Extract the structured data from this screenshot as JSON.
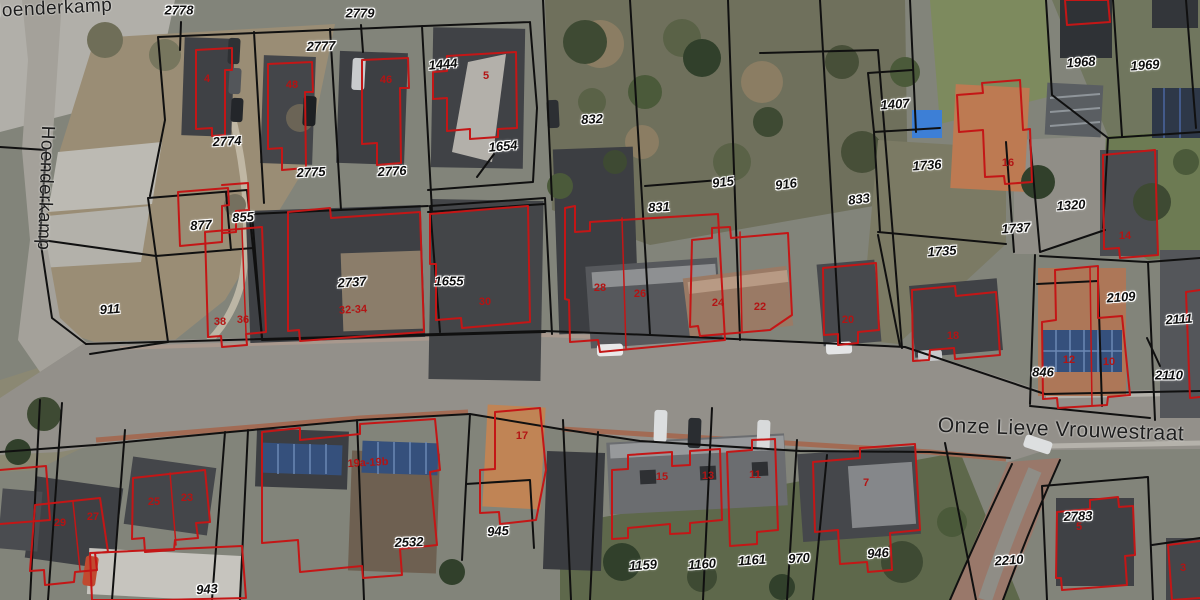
{
  "colors": {
    "parcel_line_color": "#101010",
    "building_outline_color": "#c41616",
    "house_number_color": "#b31414",
    "parcel_label_color": "#0d0d0d",
    "street_label_color": "#1d1d1d",
    "label_halo_color": "#ffffff"
  },
  "map": {
    "street_labels": [
      {
        "text": "Hoenderkamp",
        "x": 50,
        "y": 9,
        "rot": -3,
        "size": 19
      },
      {
        "text": "Hoenderkamp",
        "x": 45,
        "y": 188,
        "rot": 92,
        "size": 19
      },
      {
        "text": "Onze Lieve Vrouwestraat",
        "x": 1061,
        "y": 430,
        "rot": 2,
        "size": 21
      }
    ],
    "parcel_labels": [
      {
        "text": "2778",
        "x": 179,
        "y": 10,
        "rot": 0
      },
      {
        "text": "2779",
        "x": 360,
        "y": 13,
        "rot": 0
      },
      {
        "text": "2777",
        "x": 321,
        "y": 46,
        "rot": -2
      },
      {
        "text": "1444",
        "x": 443,
        "y": 64,
        "rot": -5
      },
      {
        "text": "2774",
        "x": 227,
        "y": 141,
        "rot": -3
      },
      {
        "text": "2775",
        "x": 311,
        "y": 172,
        "rot": -3
      },
      {
        "text": "2776",
        "x": 392,
        "y": 171,
        "rot": -3
      },
      {
        "text": "1654",
        "x": 503,
        "y": 146,
        "rot": -5
      },
      {
        "text": "832",
        "x": 592,
        "y": 119,
        "rot": -3
      },
      {
        "text": "831",
        "x": 659,
        "y": 207,
        "rot": -3
      },
      {
        "text": "915",
        "x": 723,
        "y": 182,
        "rot": -7
      },
      {
        "text": "916",
        "x": 786,
        "y": 184,
        "rot": -7
      },
      {
        "text": "833",
        "x": 859,
        "y": 199,
        "rot": -7
      },
      {
        "text": "1407",
        "x": 895,
        "y": 104,
        "rot": -4
      },
      {
        "text": "1736",
        "x": 927,
        "y": 165,
        "rot": -4
      },
      {
        "text": "1968",
        "x": 1081,
        "y": 62,
        "rot": -4
      },
      {
        "text": "1969",
        "x": 1145,
        "y": 65,
        "rot": -4
      },
      {
        "text": "1320",
        "x": 1071,
        "y": 205,
        "rot": -4
      },
      {
        "text": "1737",
        "x": 1016,
        "y": 228,
        "rot": -4
      },
      {
        "text": "877",
        "x": 201,
        "y": 225,
        "rot": -4
      },
      {
        "text": "855",
        "x": 243,
        "y": 217,
        "rot": -4
      },
      {
        "text": "911",
        "x": 110,
        "y": 309,
        "rot": -4
      },
      {
        "text": "2737",
        "x": 352,
        "y": 282,
        "rot": -4
      },
      {
        "text": "1655",
        "x": 449,
        "y": 281,
        "rot": 0
      },
      {
        "text": "1735",
        "x": 942,
        "y": 251,
        "rot": -4
      },
      {
        "text": "2109",
        "x": 1121,
        "y": 297,
        "rot": -4
      },
      {
        "text": "2111",
        "x": 1179,
        "y": 319,
        "rot": -4
      },
      {
        "text": "2110",
        "x": 1169,
        "y": 375,
        "rot": 0
      },
      {
        "text": "846",
        "x": 1043,
        "y": 372,
        "rot": 0
      },
      {
        "text": "945",
        "x": 498,
        "y": 531,
        "rot": -4
      },
      {
        "text": "2532",
        "x": 409,
        "y": 542,
        "rot": -2
      },
      {
        "text": "943",
        "x": 207,
        "y": 589,
        "rot": -4
      },
      {
        "text": "1159",
        "x": 643,
        "y": 565,
        "rot": -4
      },
      {
        "text": "1160",
        "x": 702,
        "y": 564,
        "rot": -4
      },
      {
        "text": "1161",
        "x": 752,
        "y": 560,
        "rot": -4
      },
      {
        "text": "970",
        "x": 799,
        "y": 558,
        "rot": -4
      },
      {
        "text": "946",
        "x": 878,
        "y": 553,
        "rot": -4
      },
      {
        "text": "2783",
        "x": 1078,
        "y": 516,
        "rot": -2
      },
      {
        "text": "2210",
        "x": 1009,
        "y": 560,
        "rot": -4
      }
    ],
    "house_numbers": [
      {
        "text": "4",
        "x": 207,
        "y": 79,
        "rot": 0
      },
      {
        "text": "48",
        "x": 292,
        "y": 85,
        "rot": 0
      },
      {
        "text": "46",
        "x": 386,
        "y": 80,
        "rot": 0
      },
      {
        "text": "5",
        "x": 486,
        "y": 76,
        "rot": 0
      },
      {
        "text": "38",
        "x": 220,
        "y": 322,
        "rot": 0
      },
      {
        "text": "36",
        "x": 243,
        "y": 320,
        "rot": 0
      },
      {
        "text": "32-34",
        "x": 353,
        "y": 310,
        "rot": -3
      },
      {
        "text": "30",
        "x": 485,
        "y": 302,
        "rot": 0
      },
      {
        "text": "28",
        "x": 600,
        "y": 288,
        "rot": 0
      },
      {
        "text": "26",
        "x": 640,
        "y": 294,
        "rot": 0
      },
      {
        "text": "24",
        "x": 718,
        "y": 303,
        "rot": 0
      },
      {
        "text": "22",
        "x": 760,
        "y": 307,
        "rot": 0
      },
      {
        "text": "20",
        "x": 848,
        "y": 320,
        "rot": 0
      },
      {
        "text": "18",
        "x": 953,
        "y": 336,
        "rot": 0
      },
      {
        "text": "16",
        "x": 1008,
        "y": 163,
        "rot": 0
      },
      {
        "text": "14",
        "x": 1125,
        "y": 236,
        "rot": 0
      },
      {
        "text": "12",
        "x": 1069,
        "y": 360,
        "rot": 0
      },
      {
        "text": "10",
        "x": 1109,
        "y": 362,
        "rot": 0
      },
      {
        "text": "17",
        "x": 522,
        "y": 436,
        "rot": 0
      },
      {
        "text": "19a-19b",
        "x": 368,
        "y": 463,
        "rot": -3
      },
      {
        "text": "15",
        "x": 662,
        "y": 477,
        "rot": 0
      },
      {
        "text": "13",
        "x": 708,
        "y": 476,
        "rot": 0
      },
      {
        "text": "11",
        "x": 755,
        "y": 475,
        "rot": 0
      },
      {
        "text": "29",
        "x": 60,
        "y": 523,
        "rot": 0
      },
      {
        "text": "27",
        "x": 93,
        "y": 517,
        "rot": 0
      },
      {
        "text": "25",
        "x": 154,
        "y": 502,
        "rot": 0
      },
      {
        "text": "23",
        "x": 187,
        "y": 498,
        "rot": 0
      },
      {
        "text": "7",
        "x": 866,
        "y": 483,
        "rot": 0
      },
      {
        "text": "5",
        "x": 1079,
        "y": 527,
        "rot": 0
      },
      {
        "text": "3",
        "x": 1183,
        "y": 568,
        "rot": 0
      }
    ]
  }
}
